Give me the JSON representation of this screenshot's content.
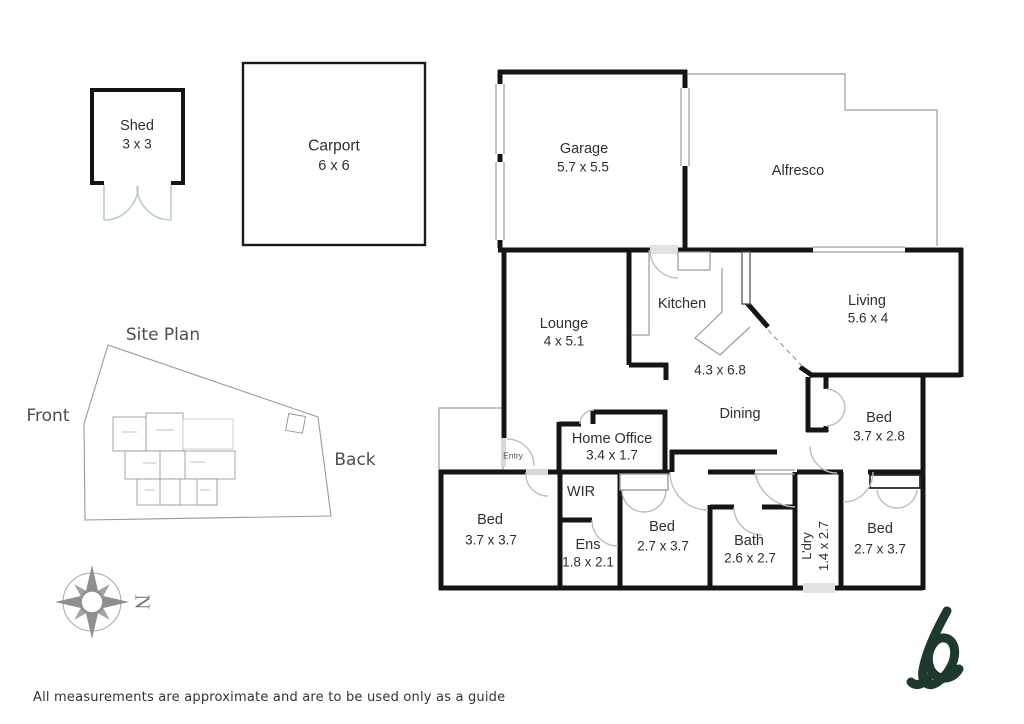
{
  "rooms": {
    "shed": {
      "name": "Shed",
      "dims": "3 x 3"
    },
    "carport": {
      "name": "Carport",
      "dims": "6 x 6"
    },
    "garage": {
      "name": "Garage",
      "dims": "5.7 x 5.5"
    },
    "alfresco": {
      "name": "Alfresco"
    },
    "lounge": {
      "name": "Lounge",
      "dims": "4 x 5.1"
    },
    "kitchen": {
      "name": "Kitchen"
    },
    "open_plan": {
      "dims": "4.3 x 6.8"
    },
    "living": {
      "name": "Living",
      "dims": "5.6 x 4"
    },
    "dining": {
      "name": "Dining"
    },
    "home_office": {
      "name": "Home Office",
      "dims": "3.4 x 1.7"
    },
    "entry": {
      "name": "Entry"
    },
    "bed_rear": {
      "name": "Bed",
      "dims": "3.7 x 2.8"
    },
    "wir": {
      "name": "WIR"
    },
    "bed_front_left": {
      "name": "Bed",
      "dims": "3.7 x 3.7"
    },
    "ens": {
      "name": "Ens",
      "dims": "1.8 x 2.1"
    },
    "bed_mid": {
      "name": "Bed",
      "dims": "2.7 x 3.7"
    },
    "bath": {
      "name": "Bath",
      "dims": "2.6 x 2.7"
    },
    "laundry": {
      "name": "L’dry",
      "dims": "1.4 x 2.7"
    },
    "bed_front_right": {
      "name": "Bed",
      "dims": "2.7 x 3.7"
    }
  },
  "site_plan": {
    "title": "Site Plan",
    "front_label": "Front",
    "back_label": "Back"
  },
  "compass": {
    "north_label": "N",
    "icon": "compass-rose-icon"
  },
  "branding": {
    "icon": "script-b-logo",
    "color": "#1e3a2c"
  },
  "footer": {
    "disclaimer": "All measurements are approximate and are to be used only as a guide"
  },
  "colors": {
    "wall": "#151515",
    "thin_line": "#9a9a9a",
    "door_arc": "#bdbdbd",
    "shed_door": "#b7cfcb",
    "site_line": "#8f8f8f",
    "text": "#2f2f2f",
    "muted_text": "#4d4d4d",
    "logo_green": "#1e3a2c"
  }
}
